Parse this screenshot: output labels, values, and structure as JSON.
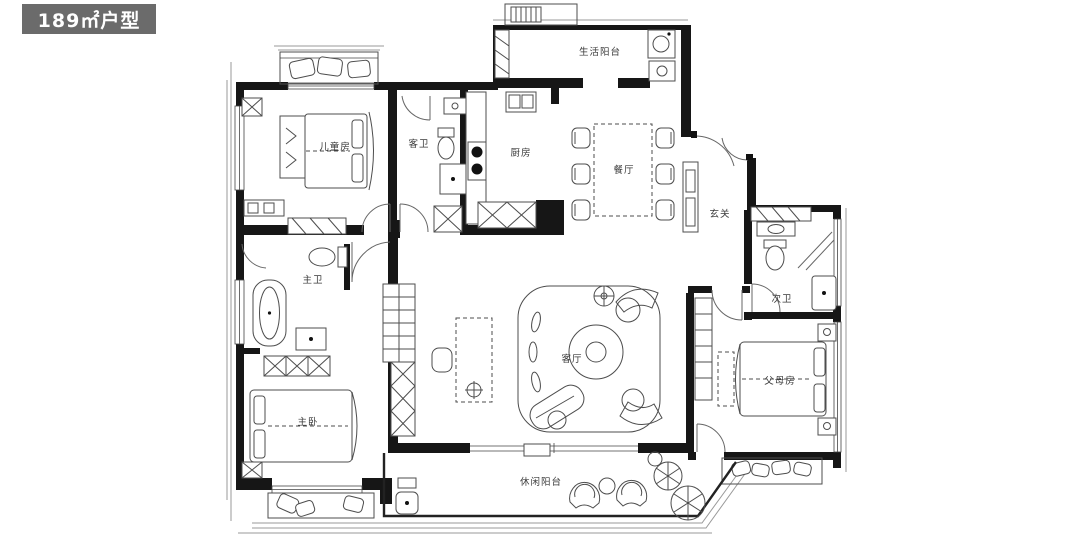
{
  "header": {
    "title": "189㎡户型"
  },
  "plan": {
    "rooms": [
      {
        "id": "children-room",
        "label": "儿童房"
      },
      {
        "id": "guest-bath",
        "label": "客卫"
      },
      {
        "id": "kitchen",
        "label": "厨房"
      },
      {
        "id": "service-balcony",
        "label": "生活阳台"
      },
      {
        "id": "dining-room",
        "label": "餐厅"
      },
      {
        "id": "foyer",
        "label": "玄关"
      },
      {
        "id": "second-bath",
        "label": "次卫"
      },
      {
        "id": "parents-room",
        "label": "父母房"
      },
      {
        "id": "living-room",
        "label": "客厅"
      },
      {
        "id": "master-bath",
        "label": "主卫"
      },
      {
        "id": "master-bedroom",
        "label": "主卧"
      },
      {
        "id": "leisure-balcony",
        "label": "休闲阳台"
      }
    ],
    "colors": {
      "wall": "#161616",
      "furniture_line": "#4d4d4d",
      "badge_bg": "#6b6b6b",
      "badge_text": "#ffffff",
      "background": "#ffffff"
    }
  }
}
